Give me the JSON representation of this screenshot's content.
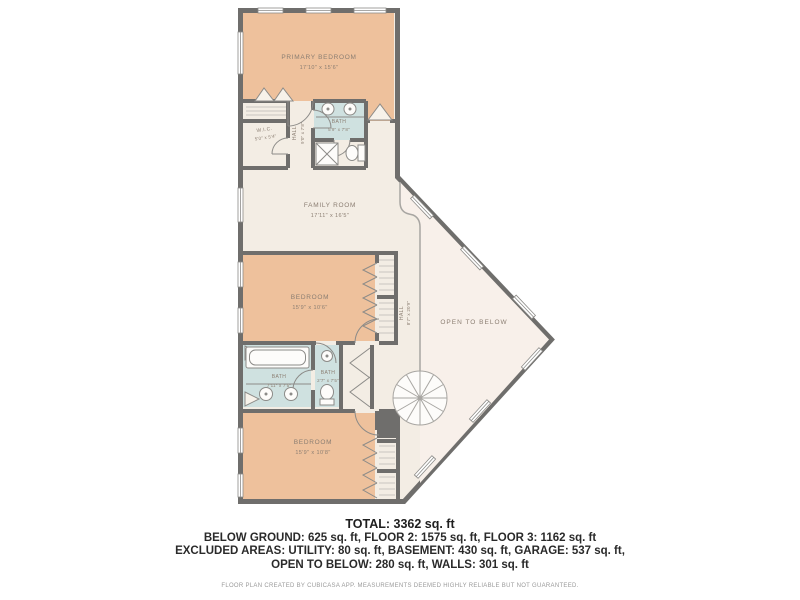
{
  "plan": {
    "rooms": {
      "primary_bedroom": {
        "name": "PRIMARY BEDROOM",
        "dims": "17'10\" x 15'6\""
      },
      "wic": {
        "name": "W.I.C.",
        "dims": "5'0\" x 5'4\""
      },
      "hall_upper": {
        "name": "HALL",
        "dims": "9'0\" x 7'8\""
      },
      "bath_upper": {
        "name": "BATH",
        "dims": "5'9\" x 7'8\""
      },
      "family_room": {
        "name": "FAMILY ROOM",
        "dims": "17'11\" x 16'5\""
      },
      "bedroom_mid": {
        "name": "BEDROOM",
        "dims": "15'9\" x 10'6\""
      },
      "hall_mid": {
        "name": "HALL",
        "dims": "8'7\" x 20'9\""
      },
      "open_to_below": {
        "name": "OPEN TO BELOW"
      },
      "bath_left": {
        "name": "BATH",
        "dims": "7'11\" x 7'5\""
      },
      "bath_right": {
        "name": "BATH",
        "dims": "2'7\" x 7'5\""
      },
      "bedroom_bottom": {
        "name": "BEDROOM",
        "dims": "15'9\" x 10'8\""
      }
    },
    "colors": {
      "wall": "#6f6e6c",
      "floor": "#f3ede4",
      "bedroom_fill": "#eec19c",
      "bath_fill": "#cfe1e0",
      "open_below_fill": "#f8f0ea",
      "label_text": "#8b7e72"
    }
  },
  "summary": {
    "total": "TOTAL: 3362 sq. ft",
    "line2": "BELOW GROUND: 625 sq. ft, FLOOR 2: 1575 sq. ft, FLOOR 3: 1162 sq. ft",
    "line3": "EXCLUDED AREAS: UTILITY: 80 sq. ft, BASEMENT: 430 sq. ft, GARAGE: 537 sq. ft,",
    "line4": "OPEN TO BELOW: 280 sq. ft, WALLS: 301 sq. ft"
  },
  "footer": {
    "disclaimer": "FLOOR PLAN CREATED BY CUBICASA APP. MEASUREMENTS DEEMED HIGHLY RELIABLE BUT NOT GUARANTEED."
  }
}
